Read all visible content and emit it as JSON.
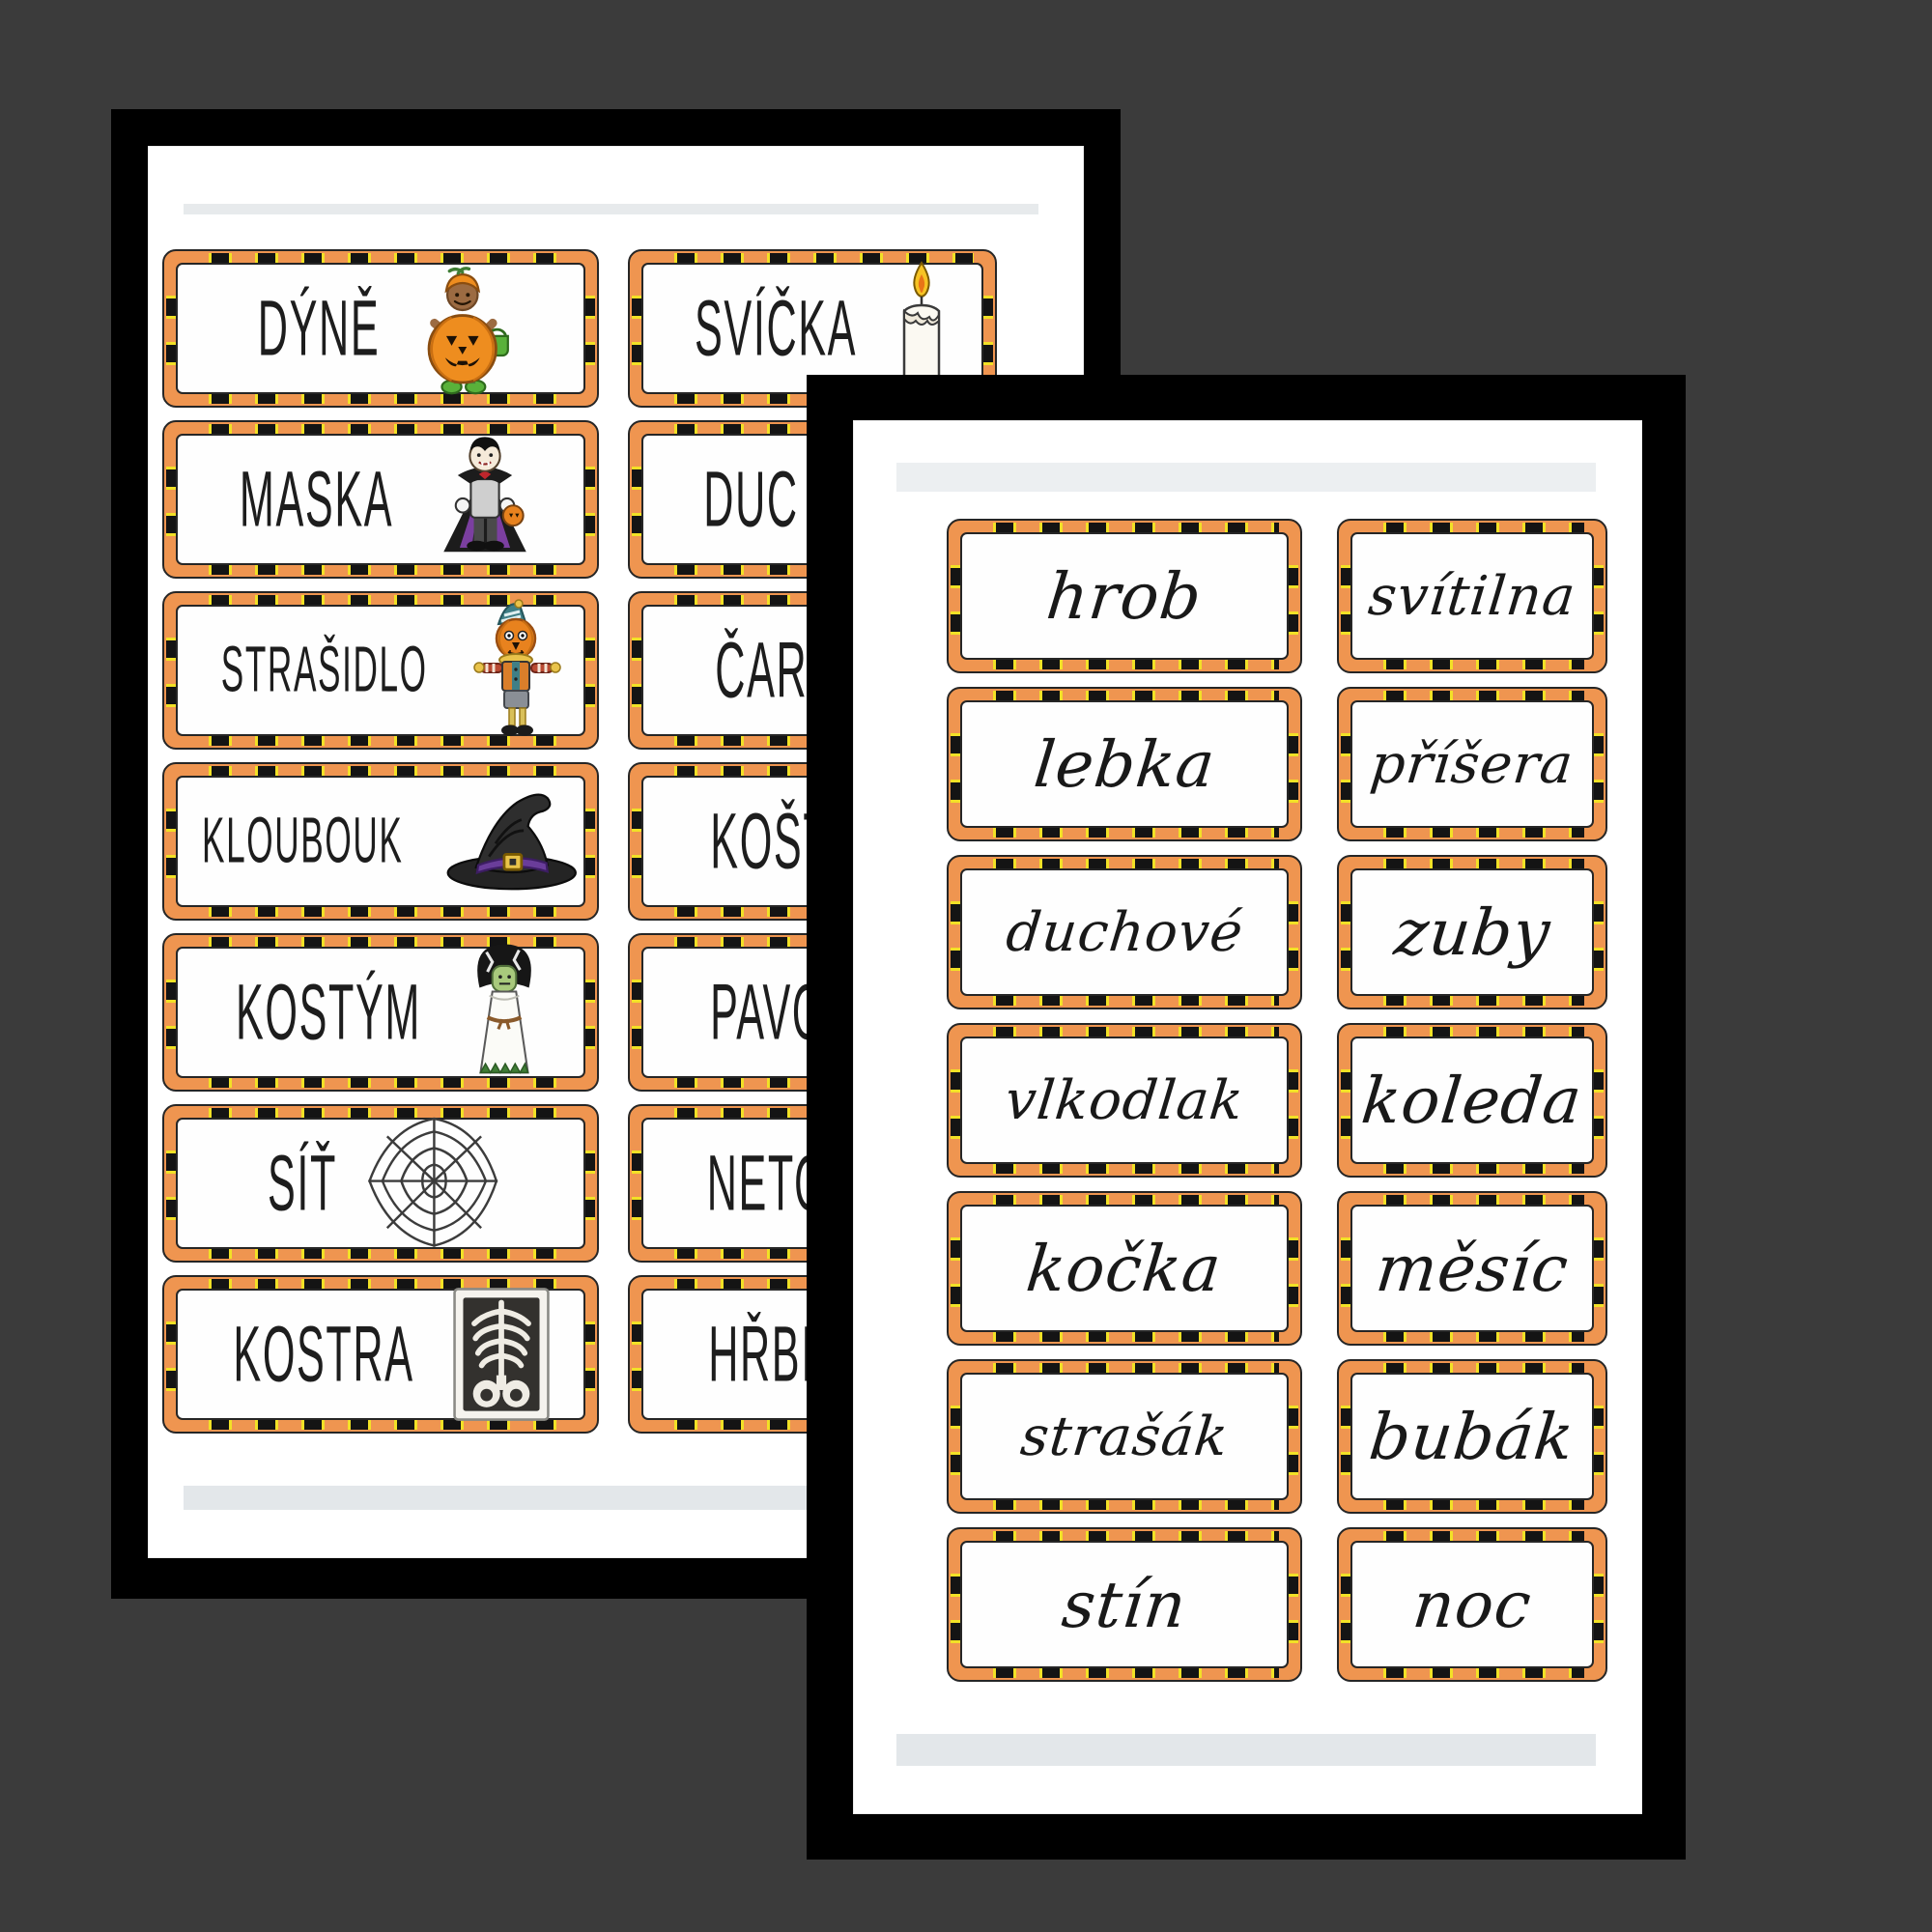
{
  "document_title": "Halloween Czech vocabulary word cards - two overlapping worksheet pages",
  "colors": {
    "canvas_bg": "#3b3b3b",
    "sheet_frame": "#000000",
    "page_bg": "#ffffff",
    "page_strip_gray": "#e7eaec",
    "stripe_orange": "#ef9550",
    "stripe_black": "#141414",
    "stripe_yellow": "#f2e126",
    "ink": "#1d1d1d"
  },
  "pages": {
    "back": {
      "description": "printed uppercase words with Halloween clip art, right column partly hidden",
      "rows": [
        {
          "left": {
            "word": "DÝNĚ",
            "icon": "pumpkin-kid-icon",
            "cut": false
          },
          "right": {
            "word": "SVÍČKA",
            "icon": "candle-icon",
            "cut": false
          }
        },
        {
          "left": {
            "word": "MASKA",
            "icon": "vampire-icon",
            "cut": false
          },
          "right": {
            "word": "DUC",
            "icon": null,
            "cut": true
          }
        },
        {
          "left": {
            "word": "STRAŠIDLO",
            "icon": "scarecrow-icon",
            "cut": false
          },
          "right": {
            "word": "ČARODĚ",
            "icon": null,
            "cut": true
          }
        },
        {
          "left": {
            "word": "KLOUBOUK",
            "icon": "witch-hat-icon",
            "cut": false
          },
          "right": {
            "word": "KOŠTĚ",
            "icon": null,
            "cut": true
          }
        },
        {
          "left": {
            "word": "KOSTÝM",
            "icon": "frankenstein-bride-icon",
            "cut": false
          },
          "right": {
            "word": "PAVOU",
            "icon": null,
            "cut": true
          }
        },
        {
          "left": {
            "word": "SÍŤ",
            "icon": "spider-web-icon",
            "cut": false
          },
          "right": {
            "word": "NETO",
            "icon": null,
            "cut": true
          }
        },
        {
          "left": {
            "word": "KOSTRA",
            "icon": "skeleton-icon",
            "cut": false
          },
          "right": {
            "word": "HŘBIT",
            "icon": null,
            "cut": true
          }
        }
      ]
    },
    "front": {
      "description": "same vocabulary written in cursive handwriting",
      "rows": [
        {
          "left": {
            "word": "hrob",
            "icon": null,
            "cut": false
          },
          "right": {
            "word": "svítilna",
            "icon": null,
            "cut": false
          }
        },
        {
          "left": {
            "word": "lebka",
            "icon": null,
            "cut": false
          },
          "right": {
            "word": "příšera",
            "icon": null,
            "cut": false
          }
        },
        {
          "left": {
            "word": "duchové",
            "icon": null,
            "cut": false
          },
          "right": {
            "word": "zuby",
            "icon": null,
            "cut": false
          }
        },
        {
          "left": {
            "word": "vlkodlak",
            "icon": null,
            "cut": false
          },
          "right": {
            "word": "koleda",
            "icon": null,
            "cut": false
          }
        },
        {
          "left": {
            "word": "kočka",
            "icon": null,
            "cut": false
          },
          "right": {
            "word": "měsíc",
            "icon": null,
            "cut": false
          }
        },
        {
          "left": {
            "word": "strašák",
            "icon": null,
            "cut": false
          },
          "right": {
            "word": "bubák",
            "icon": null,
            "cut": false
          }
        },
        {
          "left": {
            "word": "stín",
            "icon": null,
            "cut": false
          },
          "right": {
            "word": "noc",
            "icon": null,
            "cut": false
          }
        }
      ]
    }
  }
}
